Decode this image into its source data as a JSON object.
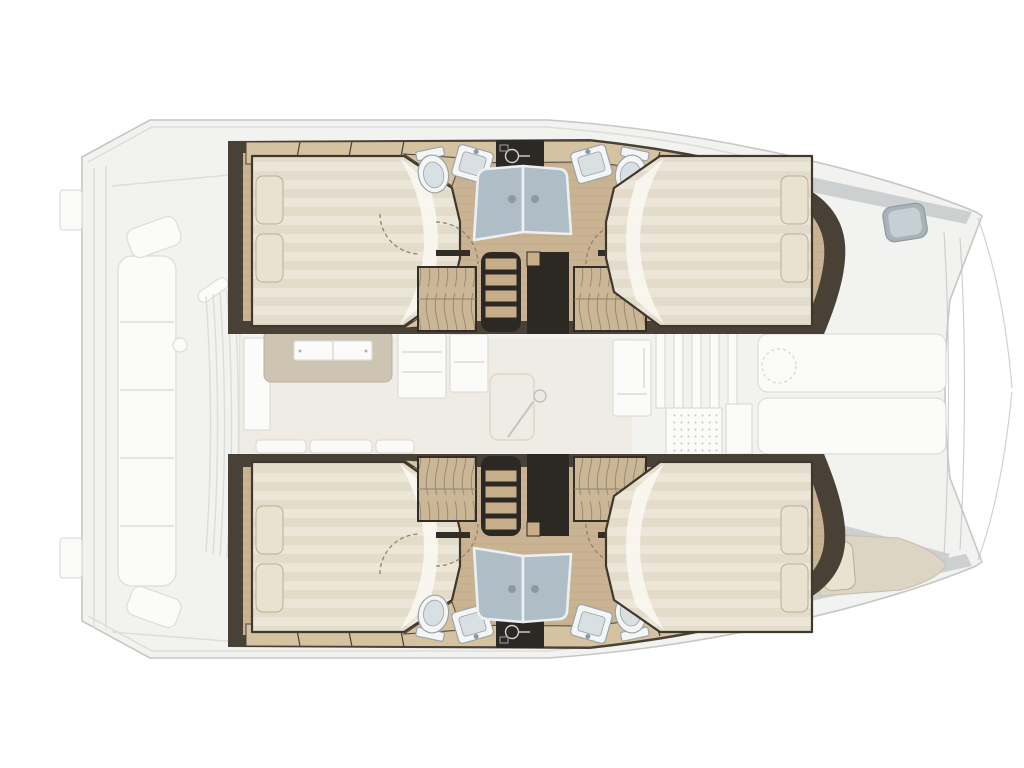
{
  "meta": {
    "type": "catamaran-interior-deck-plan",
    "orientation": "bow-right-stern-left",
    "text_labels": []
  },
  "palette": {
    "wall": "#4a4136",
    "wall_deep": "#332d27",
    "void": "#2c2823",
    "wood": "#c9b392",
    "wood_grain": "#b49e7c",
    "locker": "#d5c2a1",
    "wardrobe": "#cbb795",
    "wardrobe_line": "#8e8170",
    "mattress": "#ece6d8",
    "mattress_stripe": "#dcd3bf",
    "pillow": "#eae2d0",
    "duvet": "#f9f7f1",
    "fixture": "#f4f6f6",
    "fixture_rim": "#9aa3a8",
    "basin": "#d9e0e3",
    "glass": "#aebdc6",
    "glass_frame": "#ecf0f2",
    "handle": "#8d99a1",
    "tread": "#c6ae89",
    "door_arc": "#8d8170",
    "ext_fill": "#f2f2f0",
    "ext_line": "#c6c6c3",
    "ext_soft": "#dcdcd8",
    "ext_white": "#fbfbf9",
    "deck_band": "#c9cccd",
    "hatch": "#a8b2b8",
    "hatch_in": "#c6cfd4",
    "saloon_floor": "#efece5",
    "counter": "#cdc4b2",
    "hatch_knob": "#eceae4",
    "mat_dot": "#c6c6c3",
    "berth": "#ddd5c4",
    "berth_edge": "#c9c2b2"
  },
  "layout_regions": {
    "aft_cockpit": [
      "transom-steps",
      "cockpit-bench",
      "cockpit-table-base",
      "seat-back-slats"
    ],
    "port_hull": [
      "aft-cabin-double-berth",
      "aft-bathroom-toilet",
      "aft-bathroom-sink",
      "vanity-unit",
      "shower-enclosure",
      "companionway-stairs",
      "wardrobes",
      "forward-bathroom-sink",
      "forward-bathroom-toilet",
      "forward-cabin-double-berth"
    ],
    "starboard_hull": [
      "mirrored-copy-of-port-hull"
    ],
    "saloon": [
      "galley-counter",
      "galley-sink",
      "cabinets",
      "floor-hatch",
      "mast-step",
      "settee-cushions"
    ],
    "foredeck": [
      "window-mullions",
      "deck-mat",
      "forward-sunpads",
      "bow-deck-hatch",
      "forepeak-berth",
      "forestay-rigging"
    ]
  }
}
